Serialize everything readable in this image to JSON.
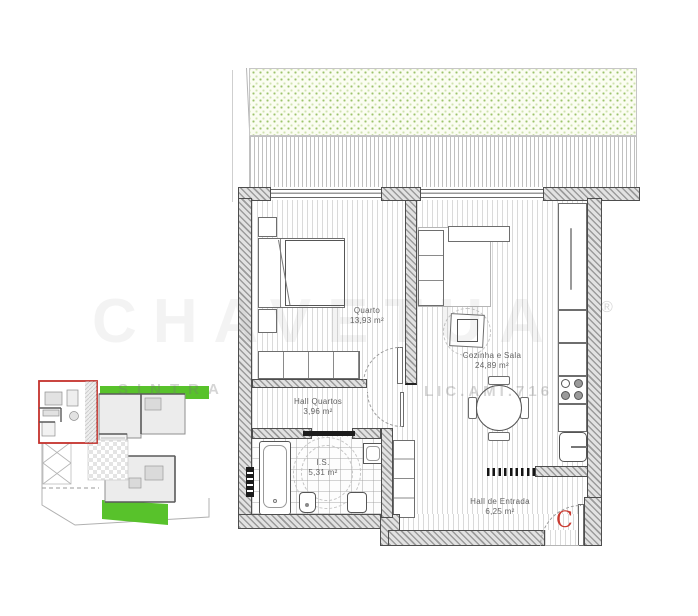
{
  "plan": {
    "rooms": [
      {
        "name": "Quarto",
        "area": "13,93 m²"
      },
      {
        "name": "Cozinha e Sala",
        "area": "24,89 m²"
      },
      {
        "name": "Hall Quartos",
        "area": "3,96 m²"
      },
      {
        "name": "I.S.",
        "area": "5,31 m²"
      },
      {
        "name": "Hall de Entrada",
        "area": "6,25 m²"
      }
    ],
    "entrance_label": "C"
  },
  "watermark": {
    "brand": "CHAVETUA",
    "registered": "®",
    "location": "SINTRA",
    "license": "LIC.AMI.716"
  },
  "colors": {
    "highlight_red": "#c4312c",
    "keyplan_green": "#58c22b",
    "garden_dot_green": "#9cc36c"
  }
}
